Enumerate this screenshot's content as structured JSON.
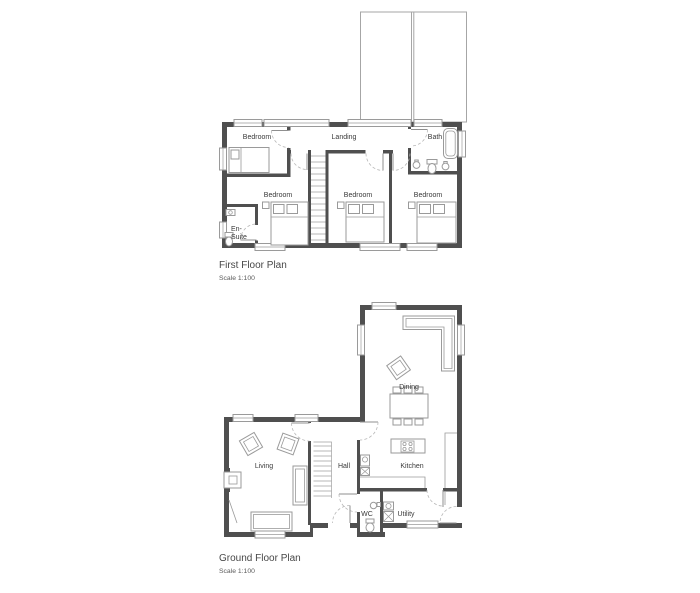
{
  "first_floor": {
    "title": "First Floor Plan",
    "scale": "Scale 1:100",
    "rooms": {
      "bedroom_top_left": "Bedroom",
      "landing": "Landing",
      "bath": "Bath",
      "bedroom_left": "Bedroom",
      "bedroom_middle": "Bedroom",
      "bedroom_right": "Bedroom",
      "ensuite_line1": "En-",
      "ensuite_line2": "Suite"
    }
  },
  "ground_floor": {
    "title": "Ground Floor Plan",
    "scale": "Scale 1:100",
    "rooms": {
      "dining": "Dining",
      "living": "Living",
      "hall": "Hall",
      "kitchen": "Kitchen",
      "wc": "WC",
      "utility": "Utility"
    }
  },
  "colors": {
    "wall": "#4f4f4f",
    "furniture": "#9a9a9a",
    "door_arc": "#b8b8b8",
    "roof": "#a6a6a6",
    "text": "#3a3a3a",
    "title": "#474747"
  }
}
